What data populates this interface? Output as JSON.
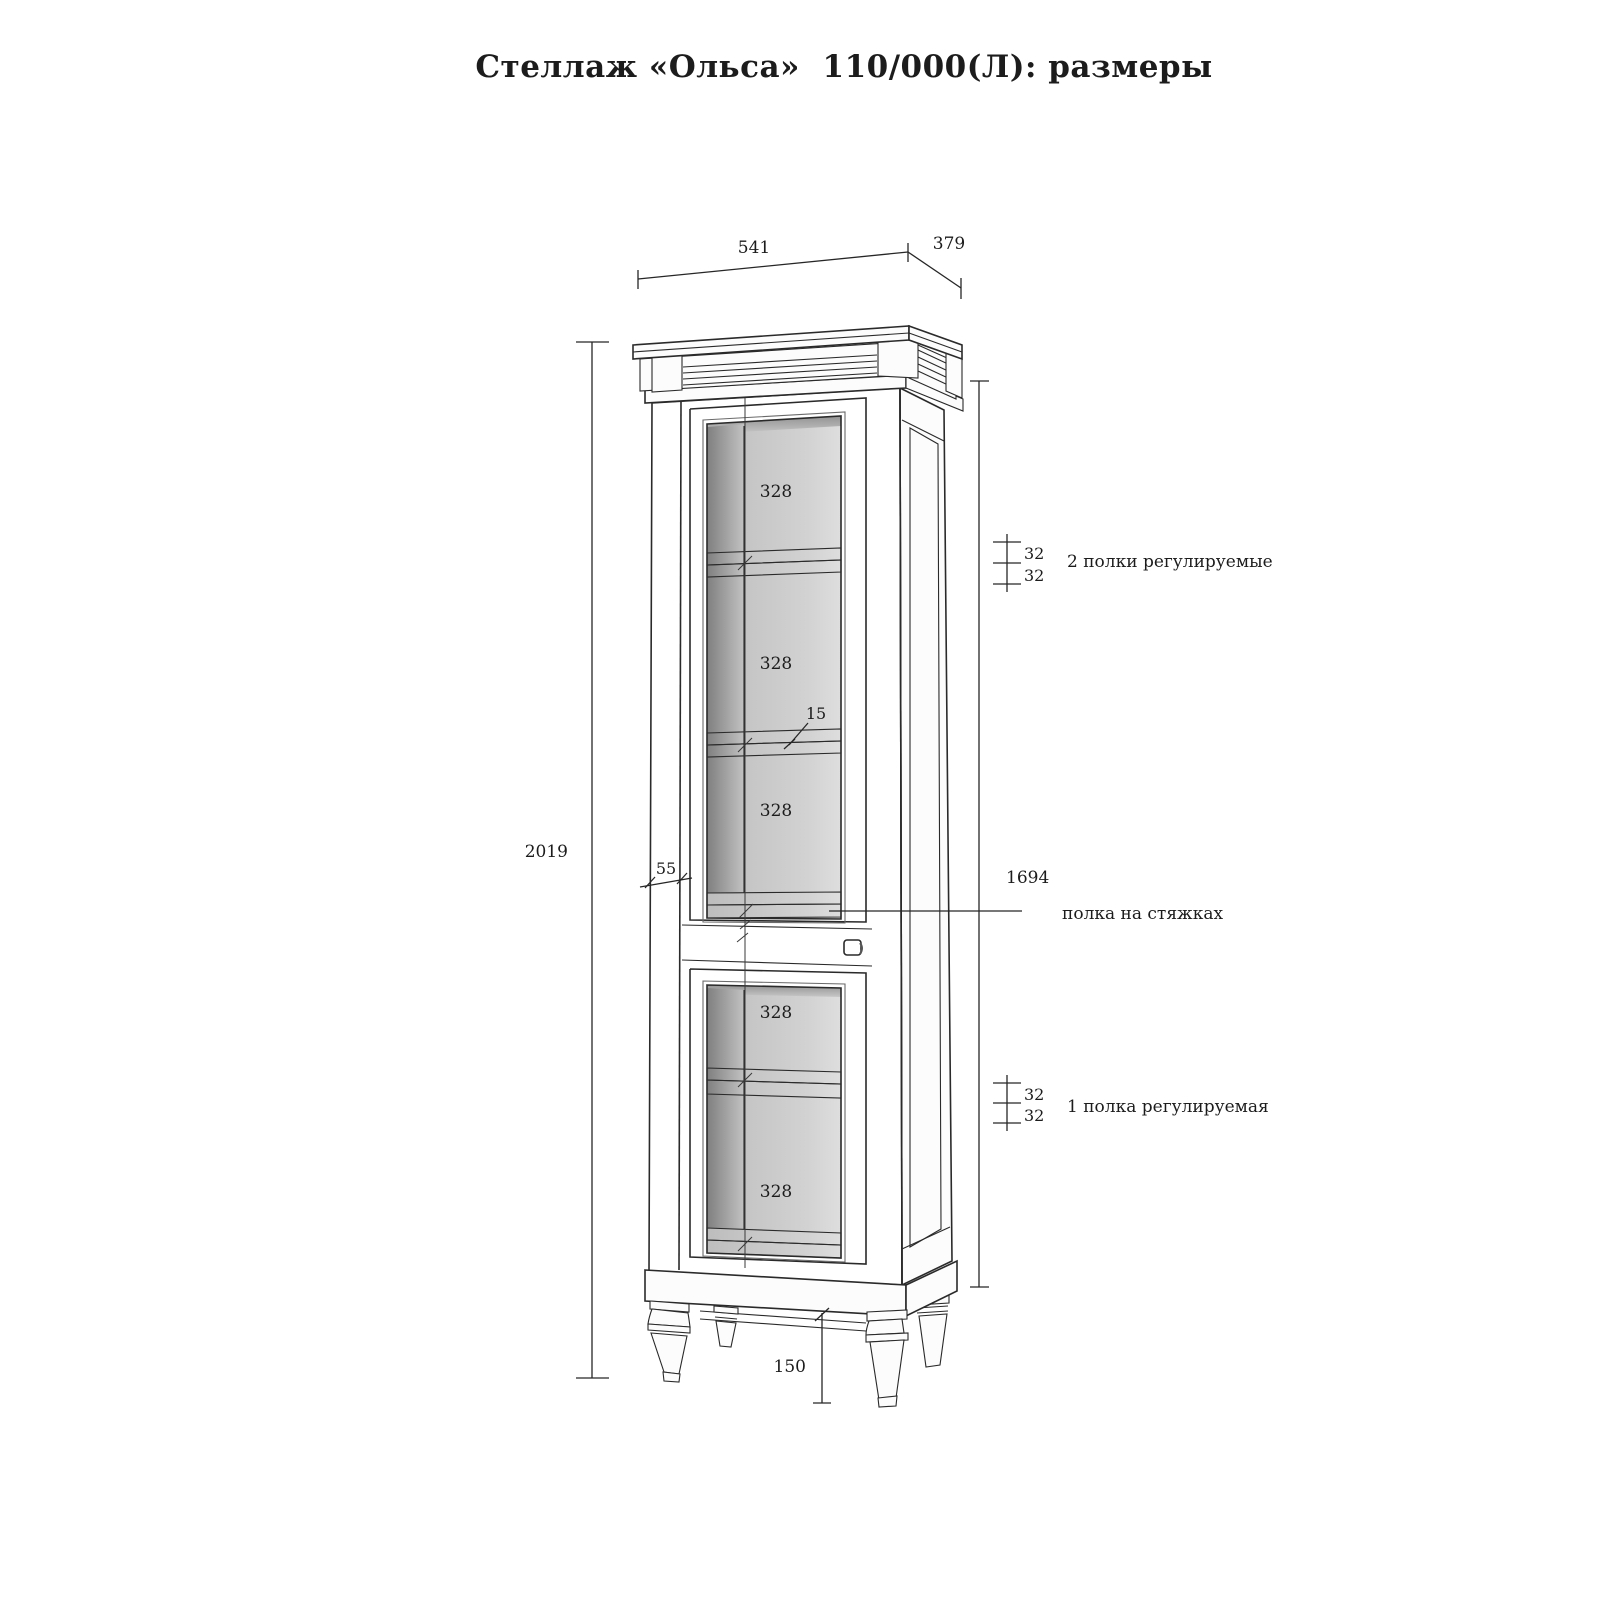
{
  "title": "Стеллаж «Ольса»  110/000(Л): размеры",
  "dims": {
    "top_width": "541",
    "top_depth": "379",
    "total_height": "2019",
    "carcass_height": "1694",
    "upper_sections": [
      "328",
      "328",
      "328"
    ],
    "lower_sections": [
      "328",
      "328"
    ],
    "upper_steps": [
      "32",
      "32"
    ],
    "lower_steps": [
      "32",
      "32"
    ],
    "shelf_thickness": "15",
    "stile_width": "55",
    "leg_height": "150"
  },
  "notes": {
    "upper_shelves": "2 полки регулируемые",
    "tie_shelf": "полка на стяжках",
    "lower_shelf": "1 полка регулируемая"
  },
  "colors": {
    "line": "#2a2a2a",
    "interior_back": "#cfcfcf",
    "interior_side": "#8e8e8e",
    "shelf_edge": "#858585",
    "side_panel": "#b5b5b5"
  }
}
